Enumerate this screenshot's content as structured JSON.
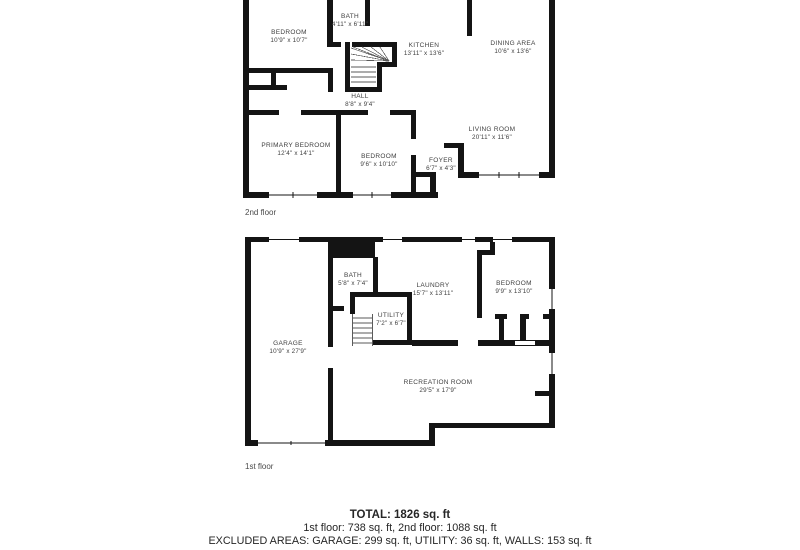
{
  "floors": [
    {
      "name": "2nd floor",
      "rooms": [
        {
          "label": "BEDROOM",
          "dims": "10'9\" x 10'7\""
        },
        {
          "label": "BATH",
          "dims": "4'11\" x 6'11\""
        },
        {
          "label": "KITCHEN",
          "dims": "13'11\" x 13'6\""
        },
        {
          "label": "DINING AREA",
          "dims": "10'6\" x 13'6\""
        },
        {
          "label": "HALL",
          "dims": "8'8\" x 9'4\""
        },
        {
          "label": "PRIMARY BEDROOM",
          "dims": "12'4\" x 14'1\""
        },
        {
          "label": "BEDROOM",
          "dims": "9'6\" x 10'10\""
        },
        {
          "label": "FOYER",
          "dims": "6'7\" x 4'3\""
        },
        {
          "label": "LIVING ROOM",
          "dims": "20'11\" x 11'6\""
        }
      ]
    },
    {
      "name": "1st floor",
      "rooms": [
        {
          "label": "BATH",
          "dims": "5'8\" x 7'4\""
        },
        {
          "label": "LAUNDRY",
          "dims": "15'7\" x 13'11\""
        },
        {
          "label": "BEDROOM",
          "dims": "9'9\" x 13'10\""
        },
        {
          "label": "UTILITY",
          "dims": "7'2\" x 6'7\""
        },
        {
          "label": "GARAGE",
          "dims": "10'9\" x 27'9\""
        },
        {
          "label": "RECREATION ROOM",
          "dims": "29'5\" x 17'9\""
        }
      ]
    }
  ],
  "summary": {
    "total_line": "TOTAL: 1826 sq. ft",
    "floors_line": "1st floor: 738 sq. ft, 2nd floor: 1088 sq. ft",
    "excluded_line": "EXCLUDED AREAS: GARAGE: 299 sq. ft, UTILITY: 36 sq. ft, WALLS: 153 sq. ft"
  },
  "colors": {
    "wall": "#141414",
    "label_text": "#3f3f3f",
    "summary_text": "#262626"
  }
}
